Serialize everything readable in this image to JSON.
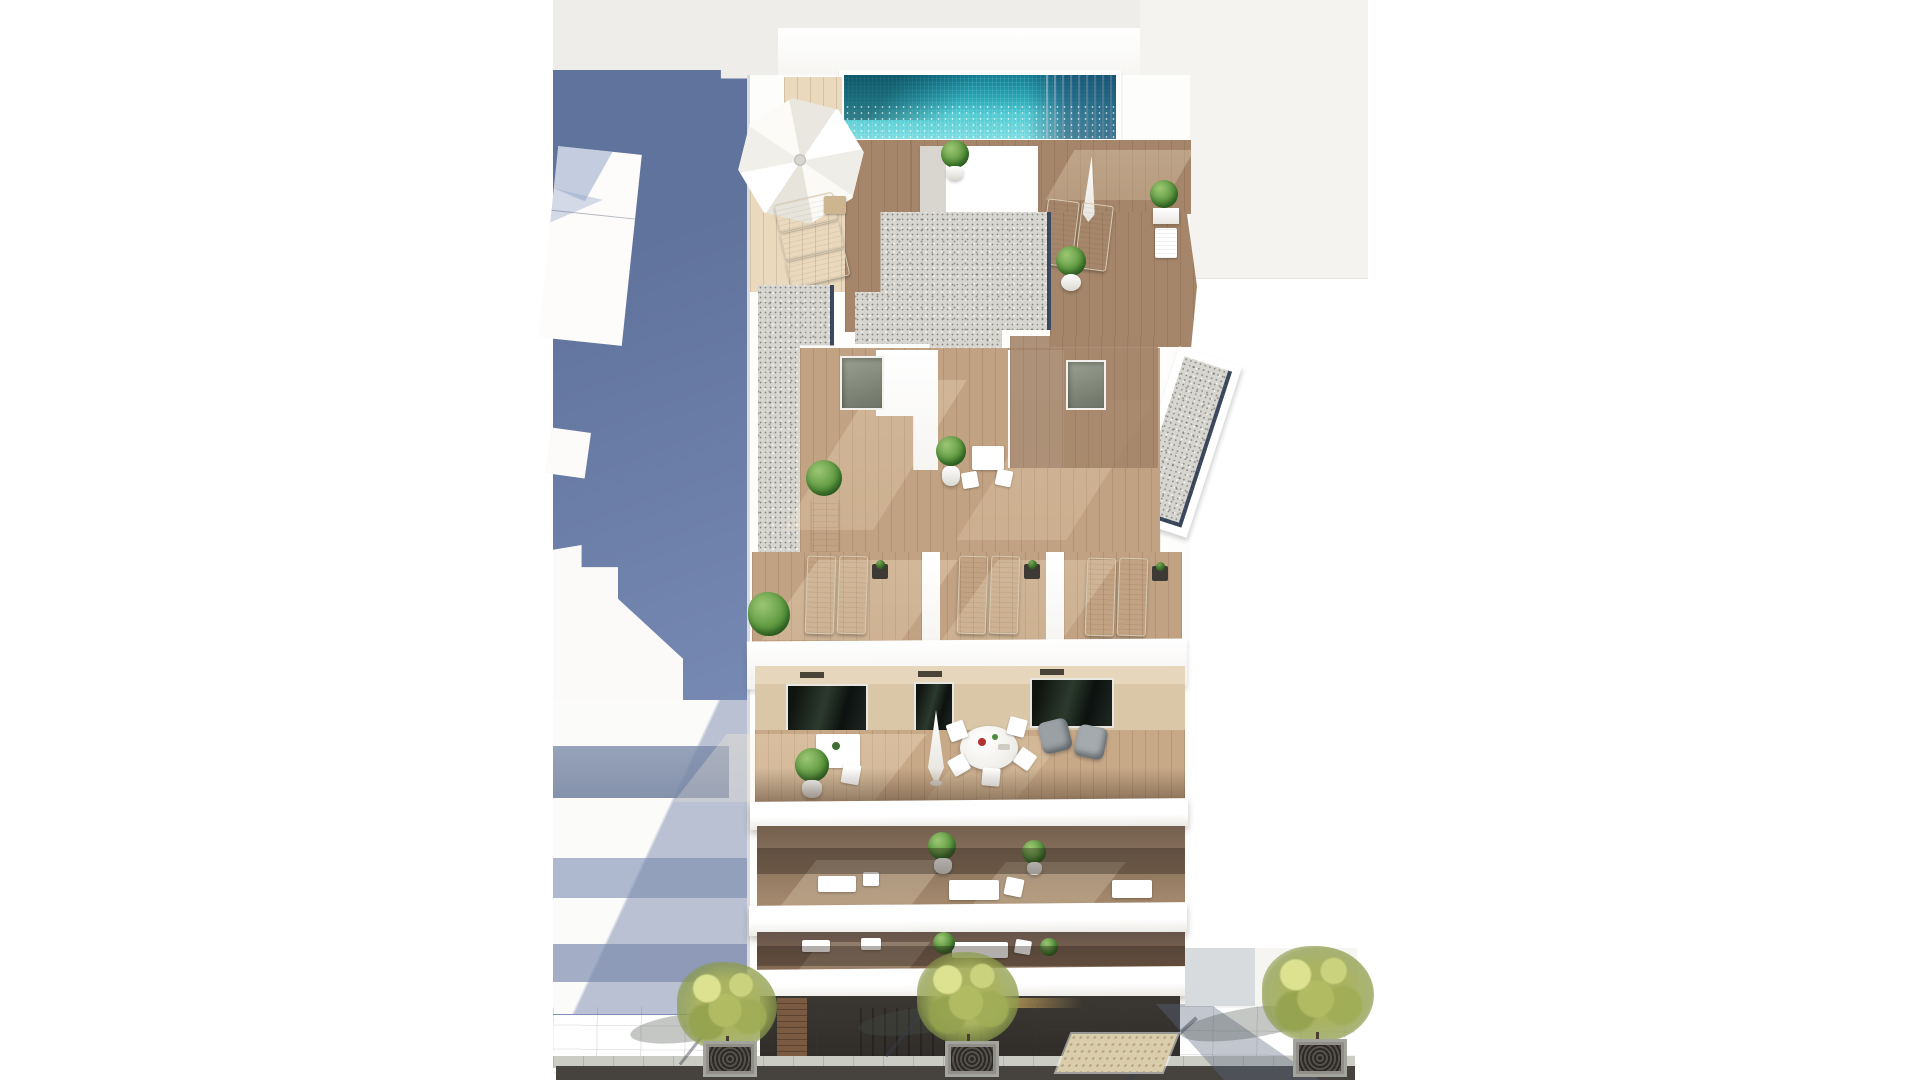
{
  "image_type": "architectural-render",
  "description": "Aerial 3D render of a white apartment building with rooftop pool, wooden roof terraces with sun loungers, stepped gravel roofs, glass-fronted balconies and a paved street with trees; neighbouring building in blue shadow on the left.",
  "palette": {
    "page-bg": "#ffffff",
    "offwhite-top": "#efede9",
    "offwhite-right": "#f4f3ef",
    "blue-shadow-1": "#60739c",
    "blue-shadow-2": "#7e91bb",
    "pool-dark": "#0f7d92",
    "pool-mid": "#2aa9b8",
    "pool-bright": "#7adde2",
    "pool-right-dark": "#24597c",
    "gravel": "#d7d5cf",
    "navy": "#22304a",
    "wood-pale": "#ead9bd",
    "wood-brown": "#a5866a",
    "wood-terrace": "#c1a282",
    "wood-pent": "#c7a887",
    "pavement-1": "#bdc1b9",
    "pavement-2": "#b1b5ad",
    "road": "#46433f",
    "tree": "#aab364",
    "neighbor-band": "#97a3ba",
    "tactile": "#d9cdab",
    "glow": "#f3c768"
  },
  "labels": {
    "scene": "aerial render of residential building",
    "pool": "rooftop swimming pool",
    "roof_umbrella": "white parasol on roof terrace",
    "gravel_roof": "gravel roof surface",
    "lounger_terrace": "terrace with sun loungers",
    "penthouse_terrace": "penthouse terrace with dining set",
    "balcony": "balcony with glass balustrade",
    "ground_floor": "ground floor storefront",
    "street": "paved sidewalk with trees",
    "neighbor_left": "adjacent building in shadow",
    "tree": "street tree with grate"
  },
  "counts": {
    "street_trees": 3,
    "lounger_pairs": 3,
    "balcony_floors": 3
  }
}
